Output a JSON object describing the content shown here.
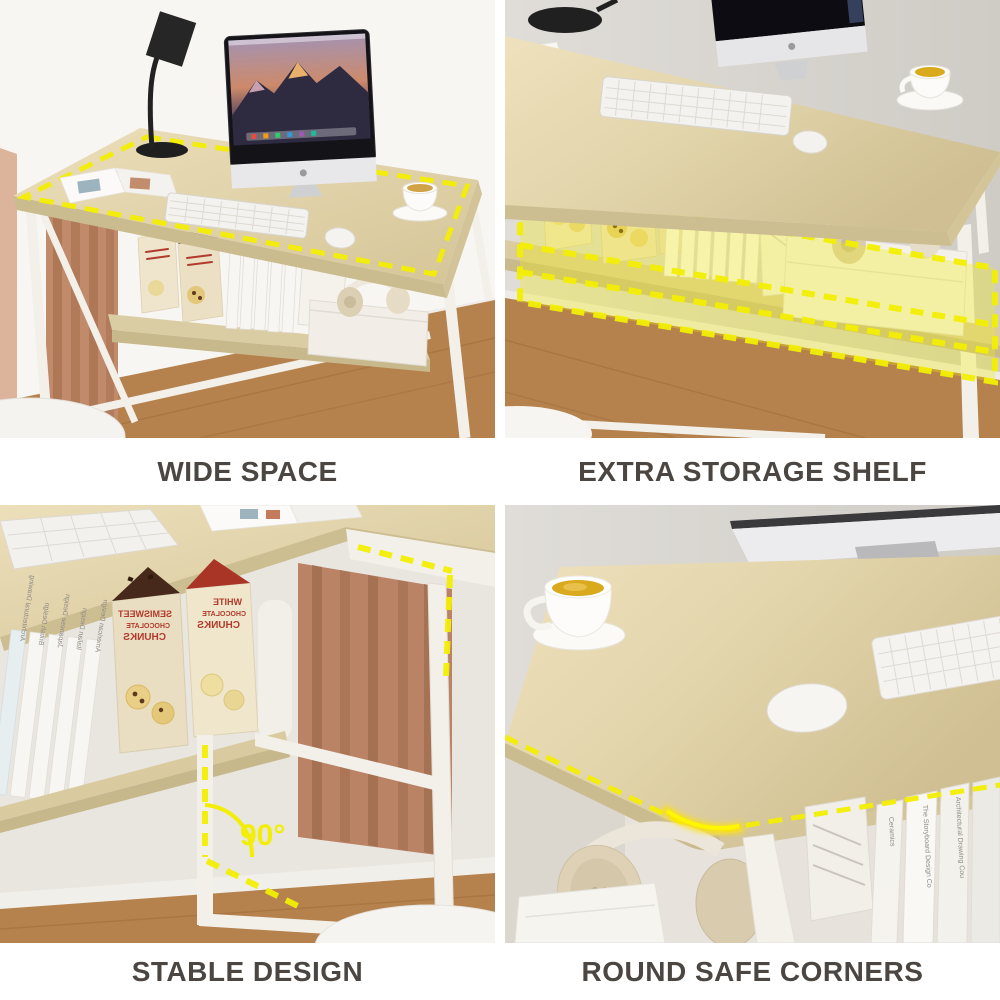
{
  "collage": {
    "type": "product-feature-grid",
    "captions": {
      "top_left": "WIDE SPACE",
      "top_right": "EXTRA STORAGE SHELF",
      "bottom_left": "STABLE DESIGN",
      "bottom_right": "ROUND SAFE CORNERS"
    },
    "annotations": {
      "right_angle": "90°"
    },
    "packages": {
      "white_chocolate": [
        "WHITE",
        "CHOCOLATE",
        "CHUNKS"
      ],
      "semisweet": [
        "SEMISWEET",
        "CHOCOLATE",
        "CHUNKS"
      ]
    },
    "books": {
      "design_series": [
        "Architectural Drawing",
        "British Design",
        "Japanese Design",
        "Italian Design",
        "American Design"
      ],
      "corner_shelf": [
        "Ceramics",
        "The Storyboard Design Co",
        "Architectural Drawing Cou"
      ]
    },
    "colors": {
      "accent_yellow": "#f2ee04",
      "caption_text": "#4b4642",
      "desk_wood": "#ddcfa5",
      "frame_white": "#f3f0ea",
      "curtain_brown": "#bd8868",
      "floor_wood": "#b5824e",
      "wall_gray": "#d6d3ce",
      "wall_light": "#f8f6f2",
      "tea_yellow": "#d9a91e"
    }
  }
}
